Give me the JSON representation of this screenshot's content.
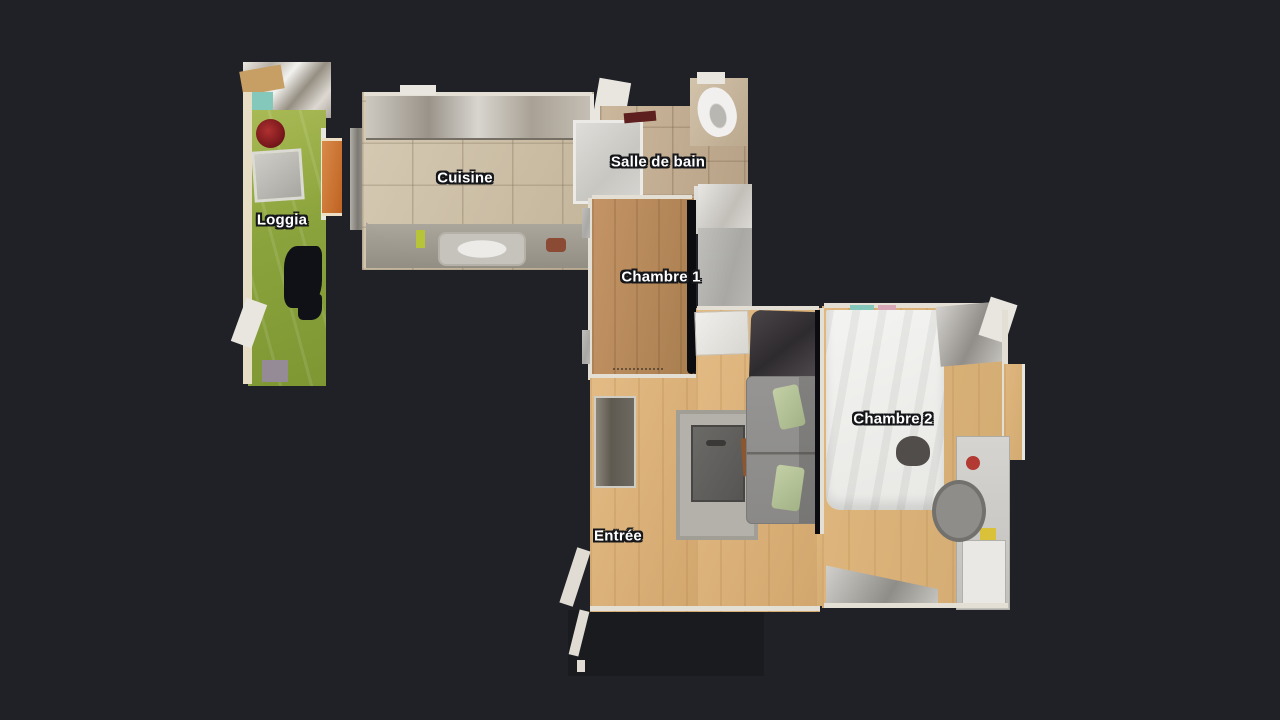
{
  "scene": {
    "view": "apartment-floor-plan-top-down-3d-scan",
    "background": "#1f2126",
    "rooms": [
      {
        "id": "loggia",
        "label": "Loggia"
      },
      {
        "id": "cuisine",
        "label": "Cuisine"
      },
      {
        "id": "salle-de-bain",
        "label": "Salle de bain"
      },
      {
        "id": "chambre-1",
        "label": "Chambre 1"
      },
      {
        "id": "entree",
        "label": "Entrée"
      },
      {
        "id": "chambre-2",
        "label": "Chambre 2"
      }
    ],
    "label_style": {
      "color": "#ffffff",
      "outline": "#15161a"
    },
    "colors": {
      "bg": "#1f2126",
      "label_color": "#ffffff",
      "loggia_green": "#8ea63e",
      "tile_beige": "#cfc2aa",
      "bath_tile": "#c3ae93",
      "wood_mid": "#b78c5c",
      "wood_light": "#debb85",
      "wall_light": "#e4dfd5",
      "wall_dark": "#0b0c10",
      "gray_floor": "#b6b5b1",
      "sofa_gray": "#8e8d8b",
      "pillow_green": "#b5c49a",
      "accent_orange": "#cc7434",
      "bed_white": "#f0f0ee"
    }
  }
}
